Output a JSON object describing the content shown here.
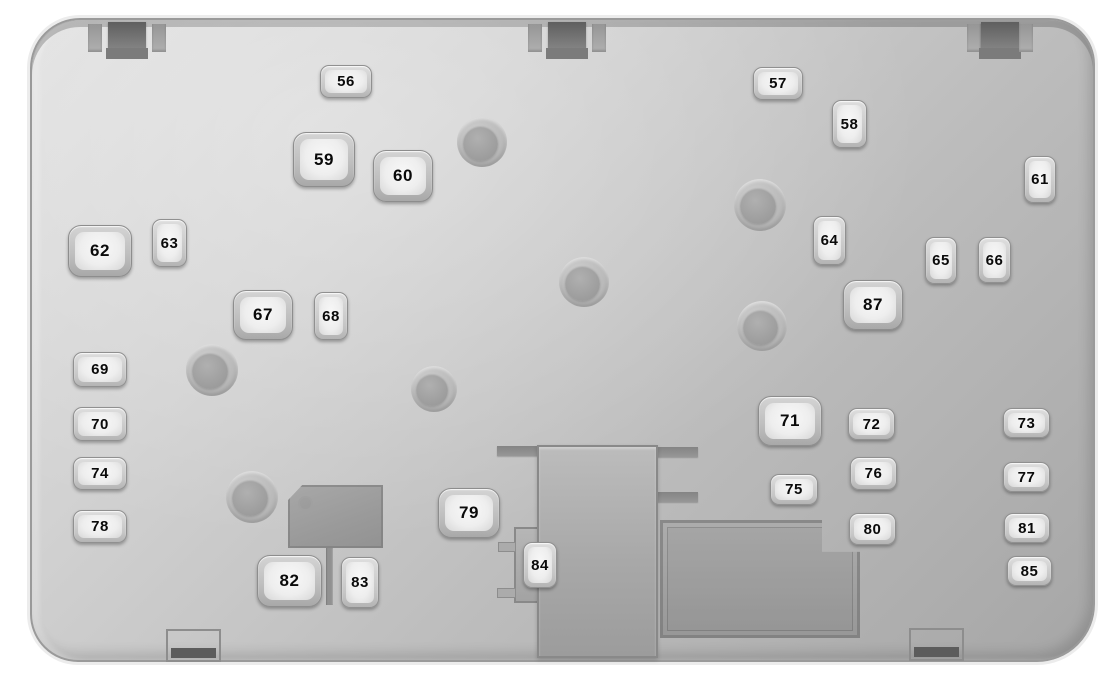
{
  "diagram": {
    "kind": "fuse-box-diagram",
    "colors": {
      "background": "#ffffff",
      "panel_light": "#e0e0e0",
      "panel_dark": "#a6a6a6",
      "rim": "#8e8e8e",
      "fuse_fill": "#f3f3f3",
      "fuse_border": "#909090",
      "label_text": "#0a0a0a",
      "tab_dark": "#5f5f5f"
    },
    "fuses": [
      {
        "label": "56",
        "x": 320,
        "y": 65,
        "w": 52,
        "h": 33,
        "kind": "h"
      },
      {
        "label": "57",
        "x": 753,
        "y": 67,
        "w": 50,
        "h": 33,
        "kind": "h"
      },
      {
        "label": "58",
        "x": 832,
        "y": 100,
        "w": 35,
        "h": 48,
        "kind": "v"
      },
      {
        "label": "59",
        "x": 293,
        "y": 132,
        "w": 62,
        "h": 55,
        "kind": "big"
      },
      {
        "label": "60",
        "x": 373,
        "y": 150,
        "w": 60,
        "h": 52,
        "kind": "big"
      },
      {
        "label": "61",
        "x": 1024,
        "y": 156,
        "w": 32,
        "h": 47,
        "kind": "v"
      },
      {
        "label": "62",
        "x": 68,
        "y": 225,
        "w": 64,
        "h": 52,
        "kind": "big"
      },
      {
        "label": "63",
        "x": 152,
        "y": 219,
        "w": 35,
        "h": 48,
        "kind": "v"
      },
      {
        "label": "64",
        "x": 813,
        "y": 216,
        "w": 33,
        "h": 49,
        "kind": "v"
      },
      {
        "label": "65",
        "x": 925,
        "y": 237,
        "w": 32,
        "h": 47,
        "kind": "v"
      },
      {
        "label": "66",
        "x": 978,
        "y": 237,
        "w": 33,
        "h": 46,
        "kind": "v"
      },
      {
        "label": "67",
        "x": 233,
        "y": 290,
        "w": 60,
        "h": 50,
        "kind": "big"
      },
      {
        "label": "68",
        "x": 314,
        "y": 292,
        "w": 34,
        "h": 48,
        "kind": "v"
      },
      {
        "label": "87",
        "x": 843,
        "y": 280,
        "w": 60,
        "h": 50,
        "kind": "big"
      },
      {
        "label": "69",
        "x": 73,
        "y": 352,
        "w": 54,
        "h": 35,
        "kind": "h"
      },
      {
        "label": "70",
        "x": 73,
        "y": 407,
        "w": 54,
        "h": 34,
        "kind": "h"
      },
      {
        "label": "71",
        "x": 758,
        "y": 396,
        "w": 64,
        "h": 50,
        "kind": "big"
      },
      {
        "label": "72",
        "x": 848,
        "y": 408,
        "w": 47,
        "h": 32,
        "kind": "h"
      },
      {
        "label": "73",
        "x": 1003,
        "y": 408,
        "w": 47,
        "h": 30,
        "kind": "h"
      },
      {
        "label": "74",
        "x": 73,
        "y": 457,
        "w": 54,
        "h": 33,
        "kind": "h"
      },
      {
        "label": "75",
        "x": 770,
        "y": 474,
        "w": 48,
        "h": 31,
        "kind": "h"
      },
      {
        "label": "76",
        "x": 850,
        "y": 457,
        "w": 47,
        "h": 33,
        "kind": "h"
      },
      {
        "label": "77",
        "x": 1003,
        "y": 462,
        "w": 47,
        "h": 30,
        "kind": "h"
      },
      {
        "label": "78",
        "x": 73,
        "y": 510,
        "w": 54,
        "h": 33,
        "kind": "h"
      },
      {
        "label": "79",
        "x": 438,
        "y": 488,
        "w": 62,
        "h": 50,
        "kind": "big"
      },
      {
        "label": "80",
        "x": 849,
        "y": 513,
        "w": 47,
        "h": 32,
        "kind": "h"
      },
      {
        "label": "81",
        "x": 1004,
        "y": 513,
        "w": 46,
        "h": 30,
        "kind": "h"
      },
      {
        "label": "82",
        "x": 257,
        "y": 555,
        "w": 65,
        "h": 52,
        "kind": "big"
      },
      {
        "label": "83",
        "x": 341,
        "y": 557,
        "w": 38,
        "h": 51,
        "kind": "v"
      },
      {
        "label": "84",
        "x": 523,
        "y": 542,
        "w": 34,
        "h": 46,
        "kind": "v"
      },
      {
        "label": "85",
        "x": 1007,
        "y": 556,
        "w": 45,
        "h": 30,
        "kind": "h"
      }
    ],
    "screw_bosses": [
      {
        "x": 482,
        "y": 142,
        "r": 25
      },
      {
        "x": 760,
        "y": 205,
        "r": 26
      },
      {
        "x": 584,
        "y": 282,
        "r": 25
      },
      {
        "x": 762,
        "y": 326,
        "r": 25
      },
      {
        "x": 212,
        "y": 370,
        "r": 26
      },
      {
        "x": 434,
        "y": 389,
        "r": 23
      },
      {
        "x": 252,
        "y": 497,
        "r": 26
      }
    ],
    "top_tabs": [
      {
        "x": 88,
        "w": 78
      },
      {
        "x": 528,
        "w": 78
      },
      {
        "x": 967,
        "w": 66,
        "narrow": true
      }
    ],
    "bottom_tabs": [
      {
        "x": 166,
        "y": 629,
        "w": 55,
        "h": 33
      },
      {
        "x": 909,
        "y": 628,
        "w": 55,
        "h": 33
      }
    ],
    "connector": {
      "body": {
        "x": 537,
        "y": 445,
        "w": 121,
        "h": 213
      },
      "pocket": {
        "x": 514,
        "y": 527,
        "w": 27,
        "h": 76
      },
      "bars": [
        {
          "x": 497,
          "y": 446,
          "w": 42,
          "h": 10
        },
        {
          "x": 656,
          "y": 447,
          "w": 42,
          "h": 10
        },
        {
          "x": 656,
          "y": 492,
          "w": 42,
          "h": 10
        }
      ],
      "nubs": [
        {
          "x": 498,
          "y": 542,
          "w": 18,
          "h": 10
        },
        {
          "x": 497,
          "y": 588,
          "w": 19,
          "h": 10
        }
      ]
    },
    "relay_blocks": {
      "small": {
        "x": 288,
        "y": 485,
        "w": 95,
        "h": 63
      },
      "slot": {
        "x": 326,
        "y": 548,
        "w": 7,
        "h": 57
      },
      "large": {
        "x": 660,
        "y": 520,
        "w": 200,
        "h": 118
      }
    }
  }
}
